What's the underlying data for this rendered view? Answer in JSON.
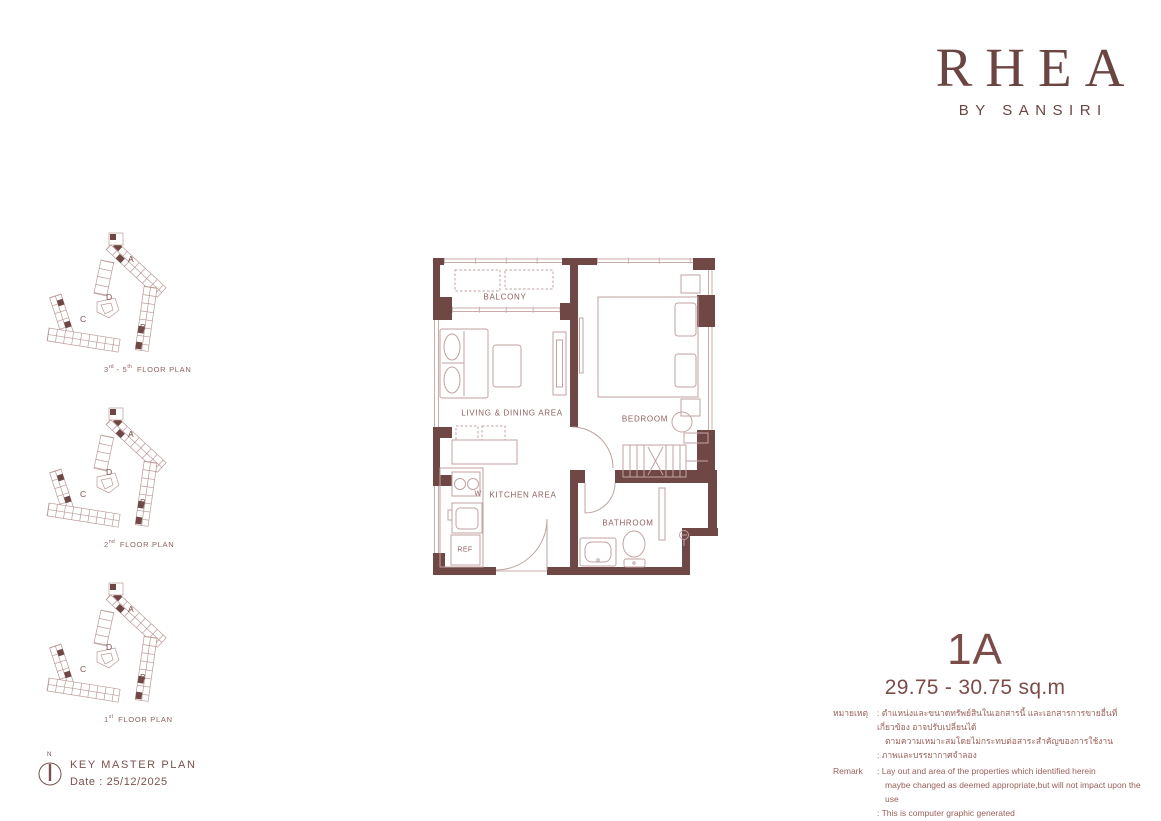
{
  "colors": {
    "wall": "#6F4846",
    "accent": "#6B4541",
    "line": "#C9ACAA",
    "label": "#8E625F"
  },
  "logo": {
    "title": "RHEA",
    "subtitle": "BY SANSIRI"
  },
  "key_plans": [
    {
      "floor_num": "3",
      "floor_sup": "rd",
      "range_sep": " - ",
      "floor_num2": "5",
      "floor_sup2": "th",
      "label": "FLOOR PLAN"
    },
    {
      "floor_num": "2",
      "floor_sup": "nd",
      "range_sep": "",
      "floor_num2": "",
      "floor_sup2": "",
      "label": "FLOOR PLAN"
    },
    {
      "floor_num": "1",
      "floor_sup": "st",
      "range_sep": "",
      "floor_num2": "",
      "floor_sup2": "",
      "label": "FLOOR PLAN"
    }
  ],
  "building_labels": {
    "a": "A",
    "b": "B",
    "c": "C",
    "d": "D"
  },
  "floor_plan": {
    "rooms": {
      "balcony": "BALCONY",
      "living": "LIVING & DINING AREA",
      "bedroom": "BEDROOM",
      "kitchen": "KITCHEN AREA",
      "bathroom": "BATHROOM",
      "ref": "REF",
      "washer": "W"
    }
  },
  "unit": {
    "name": "1A",
    "area": "29.75 - 30.75 sq.m"
  },
  "remarks": {
    "thai_label": "หมายเหตุ",
    "thai_line1": ": ตำแหน่งและขนาดทรัพย์สินในเอกสารนี้ และเอกสารการขายอื่นที่เกี่ยวข้อง อาจปรับเปลี่ยนได้",
    "thai_line2": "ตามความเหมาะสมโดยไม่กระทบต่อสาระสำคัญของการใช้งาน",
    "thai_line3": ": ภาพและบรรยากาศจำลอง",
    "en_label": "Remark",
    "en_line1": ": Lay out and area of the properties which identified herein",
    "en_line2": "maybe changed as deemed appropriate,but will not impact upon the use",
    "en_line3": ": This is computer graphic generated"
  },
  "key_master": {
    "title": "KEY MASTER  PLAN",
    "date": "Date  : 25/12/2025",
    "north": "N"
  }
}
